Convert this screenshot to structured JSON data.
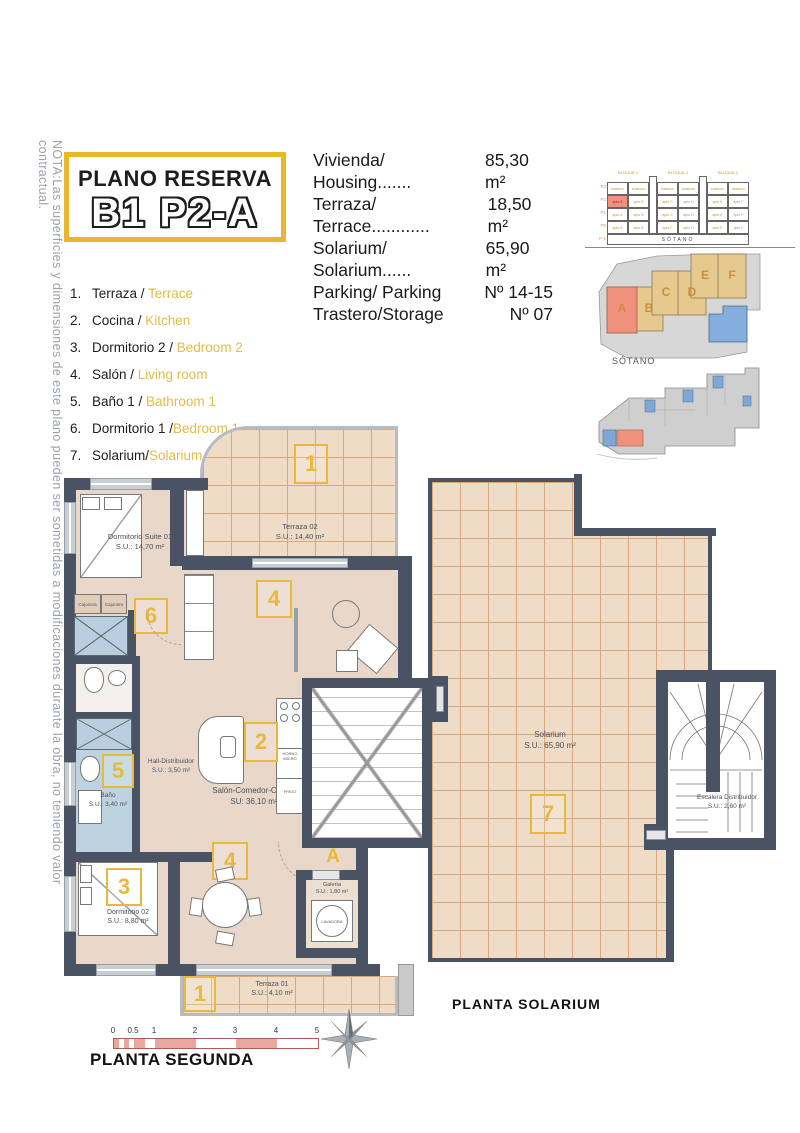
{
  "note": {
    "text": "NOTA:Las superficies y dimensiones de este plano pueden ser sometidas a modificaciones durante la obra, no teniendo valor contractual."
  },
  "title_box": {
    "line1": "PLANO RESERVA",
    "line2": "B1 P2-A"
  },
  "summary": {
    "rows": [
      {
        "label": "Vivienda/ Housing.......",
        "value": "85,30 m²"
      },
      {
        "label": "Terraza/ Terrace............",
        "value": "18,50 m²"
      },
      {
        "label": "Solarium/ Solarium......",
        "value": "65,90 m²"
      },
      {
        "label": "Parking/ Parking",
        "value": "Nº 14-15"
      },
      {
        "label": "Trastero/Storage",
        "value": "Nº 07"
      }
    ]
  },
  "legend": {
    "items": [
      {
        "n": "1.",
        "es": "Terraza / ",
        "en": "Terrace"
      },
      {
        "n": "2.",
        "es": "Cocina / ",
        "en": "Kitchen"
      },
      {
        "n": "3.",
        "es": "Dormitorio 2 / ",
        "en": "Bedroom 2"
      },
      {
        "n": "4.",
        "es": "Salón / ",
        "en": "Living room"
      },
      {
        "n": "5.",
        "es": "Baño 1 / ",
        "en": "Bathroom 1"
      },
      {
        "n": "6.",
        "es": "Dormitorio 1 /",
        "en": "Bedroom 1"
      },
      {
        "n": "7.",
        "es": "Solarium/",
        "en": "Solarium"
      }
    ]
  },
  "elevation": {
    "blocks": [
      "BLOQUE 1",
      "BLOQUE 2",
      "BLOQUE 3"
    ],
    "floors": [
      "P3",
      "P2",
      "P1",
      "P0",
      "P-1"
    ],
    "sotano": "SÓTANO",
    "top_row_label": "solarium",
    "unit_labels": [
      "apto A",
      "apto B",
      "apto C",
      "apto D",
      "apto E",
      "apto F"
    ],
    "highlight_color": "#f0917e"
  },
  "siteplan": {
    "buildings": [
      "A",
      "B",
      "C",
      "D",
      "E",
      "F"
    ],
    "highlight": "A"
  },
  "sotano_plan": {
    "label": "SÓTANO"
  },
  "plan2": {
    "terraza02": {
      "name": "Terraza 02",
      "area": "S.U.: 14,40 m²",
      "tag": "1"
    },
    "suite": {
      "name": "Dormitorio Suite 01",
      "area": "S.U.: 14,70 m²",
      "tag": "6"
    },
    "cajonera1": "Cajonera",
    "cajonera2": "Cajonera",
    "hall": {
      "name": "Hall-Distribuidor",
      "area": "S.U.: 3,50 m²"
    },
    "bano": {
      "name": "Baño",
      "area": "S.U.: 3,40 m²",
      "tag": "5"
    },
    "salon": {
      "name": "Salón-Comedor-Cocina",
      "area": "SU: 36,10 m²",
      "tag_cocina": "2",
      "tag_salon": "4",
      "tag_comedor": "4"
    },
    "horno": "HORNO MICRO",
    "frigo": "FRIGO",
    "dorm02": {
      "name": "Dormitorio 02",
      "area": "S.U.: 8,80 m²",
      "tag": "3"
    },
    "galeria": {
      "name": "Galería",
      "area": "S.U.: 1,80 m²",
      "appliance": "LAVADORA"
    },
    "terraza01": {
      "name": "Terraza 01",
      "area": "S.U.: 4,10 m²",
      "tag": "1"
    },
    "entrance_tag": "A",
    "caption": "PLANTA SEGUNDA"
  },
  "solarium_plan": {
    "solarium": {
      "name": "Solarium",
      "area": "S.U.: 65,90 m²",
      "tag": "7"
    },
    "escalera": {
      "name": "Escalera Distribuidor",
      "area": "S.U.: 2,60 m²"
    },
    "caption": "PLANTA SOLARIUM"
  },
  "scalebar": {
    "ticks": [
      "0",
      "0.5",
      "1",
      "2",
      "3",
      "4",
      "5"
    ]
  }
}
